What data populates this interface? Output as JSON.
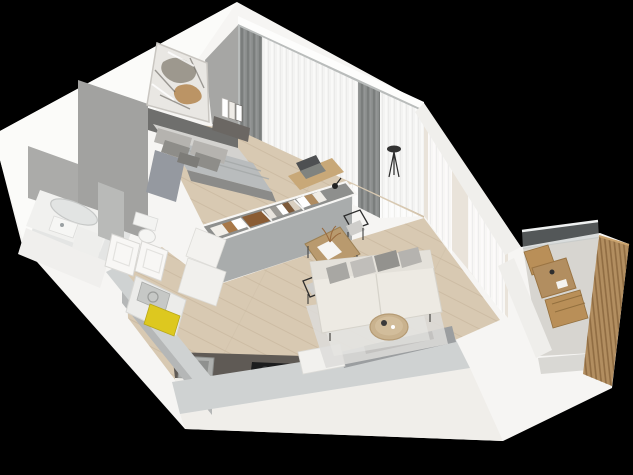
{
  "scene": {
    "kind": "3d-cutaway-floor-plan-render",
    "view": "axonometric-from-above",
    "background": "black",
    "rooms": [
      {
        "name": "bedroom",
        "furniture": [
          "double-bed",
          "gray-bedding",
          "pillows",
          "headboard",
          "abstract-wall-art",
          "nightstand-books",
          "floor-lamp",
          "sheer-curtains",
          "gray-drape-panels",
          "desk-with-laptop"
        ]
      },
      {
        "name": "bathroom",
        "furniture": [
          "built-in-bathtub",
          "toilet",
          "white-partition-doors"
        ]
      },
      {
        "name": "hallway",
        "furniture": [
          "white-doors",
          "appliance-niche",
          "washing-machine",
          "yellow-box"
        ]
      },
      {
        "name": "kitchen",
        "furniture": [
          "dark-countertop",
          "steel-sink",
          "black-cooktop",
          "white-cabinet"
        ]
      },
      {
        "name": "living-room",
        "furniture": [
          "wardrobe-divider-with-clothes",
          "dining-table",
          "wire-chairs",
          "cream-sofa",
          "gray-pillows",
          "round-coffee-table",
          "area-rug",
          "tv-accent-panel",
          "tv"
        ]
      },
      {
        "name": "balcony",
        "furniture": [
          "wooden-folding-table",
          "wooden-folding-chairs",
          "glass-railing",
          "wood-slat-screen"
        ]
      }
    ]
  },
  "colors": {
    "background": "#000000",
    "exterior_white": "#f6f5f3",
    "exterior_bright": "#fbfbf9",
    "exterior_shadow": "#f0eeea",
    "wall_top": "#cfd2d2",
    "wall_gray": "#a9acac",
    "wall_gray_light": "#b9bcbb",
    "wall_gray_dark": "#a2a2a0",
    "wall_beige": "#e9e3da",
    "floor_wood": "#d8c9b2",
    "floor_wood_line": "#bfae94",
    "floor_bath": "#e4e5e4",
    "floor_balcony": "#d7d5d0",
    "curtain_sheer": "#f4f3f1",
    "curtain_drape": "#8a8d8c",
    "bed_frame": "#6f6f6d",
    "bed_duvet": "#b9bcbd",
    "bed_mattress": "#d3d2cf",
    "pillow_gray": "#9c9b97",
    "art_tan": "#b3854f",
    "art_gray": "#8a8478",
    "sofa_cream": "#edeae3",
    "rug_gray": "#dddcd9",
    "coffee_table_tan": "#c9b28e",
    "dining_wood": "#b99a6e",
    "chair_metal": "#2e2e2e",
    "counter_dark": "#5f5a55",
    "cooktop_black": "#1c1d1e",
    "sink_steel": "#aeb0ae",
    "accent_yellow": "#ddc81f",
    "appliance_gray": "#c6c8c6",
    "tv_dark": "#2f3031",
    "tv_panel_gray": "#9b9ea0",
    "balcony_wood": "#b28e60",
    "balcony_wood_dark": "#8f6c42",
    "fixture_white": "#f1f1ef",
    "glass_tint": "#b7c0c4"
  }
}
